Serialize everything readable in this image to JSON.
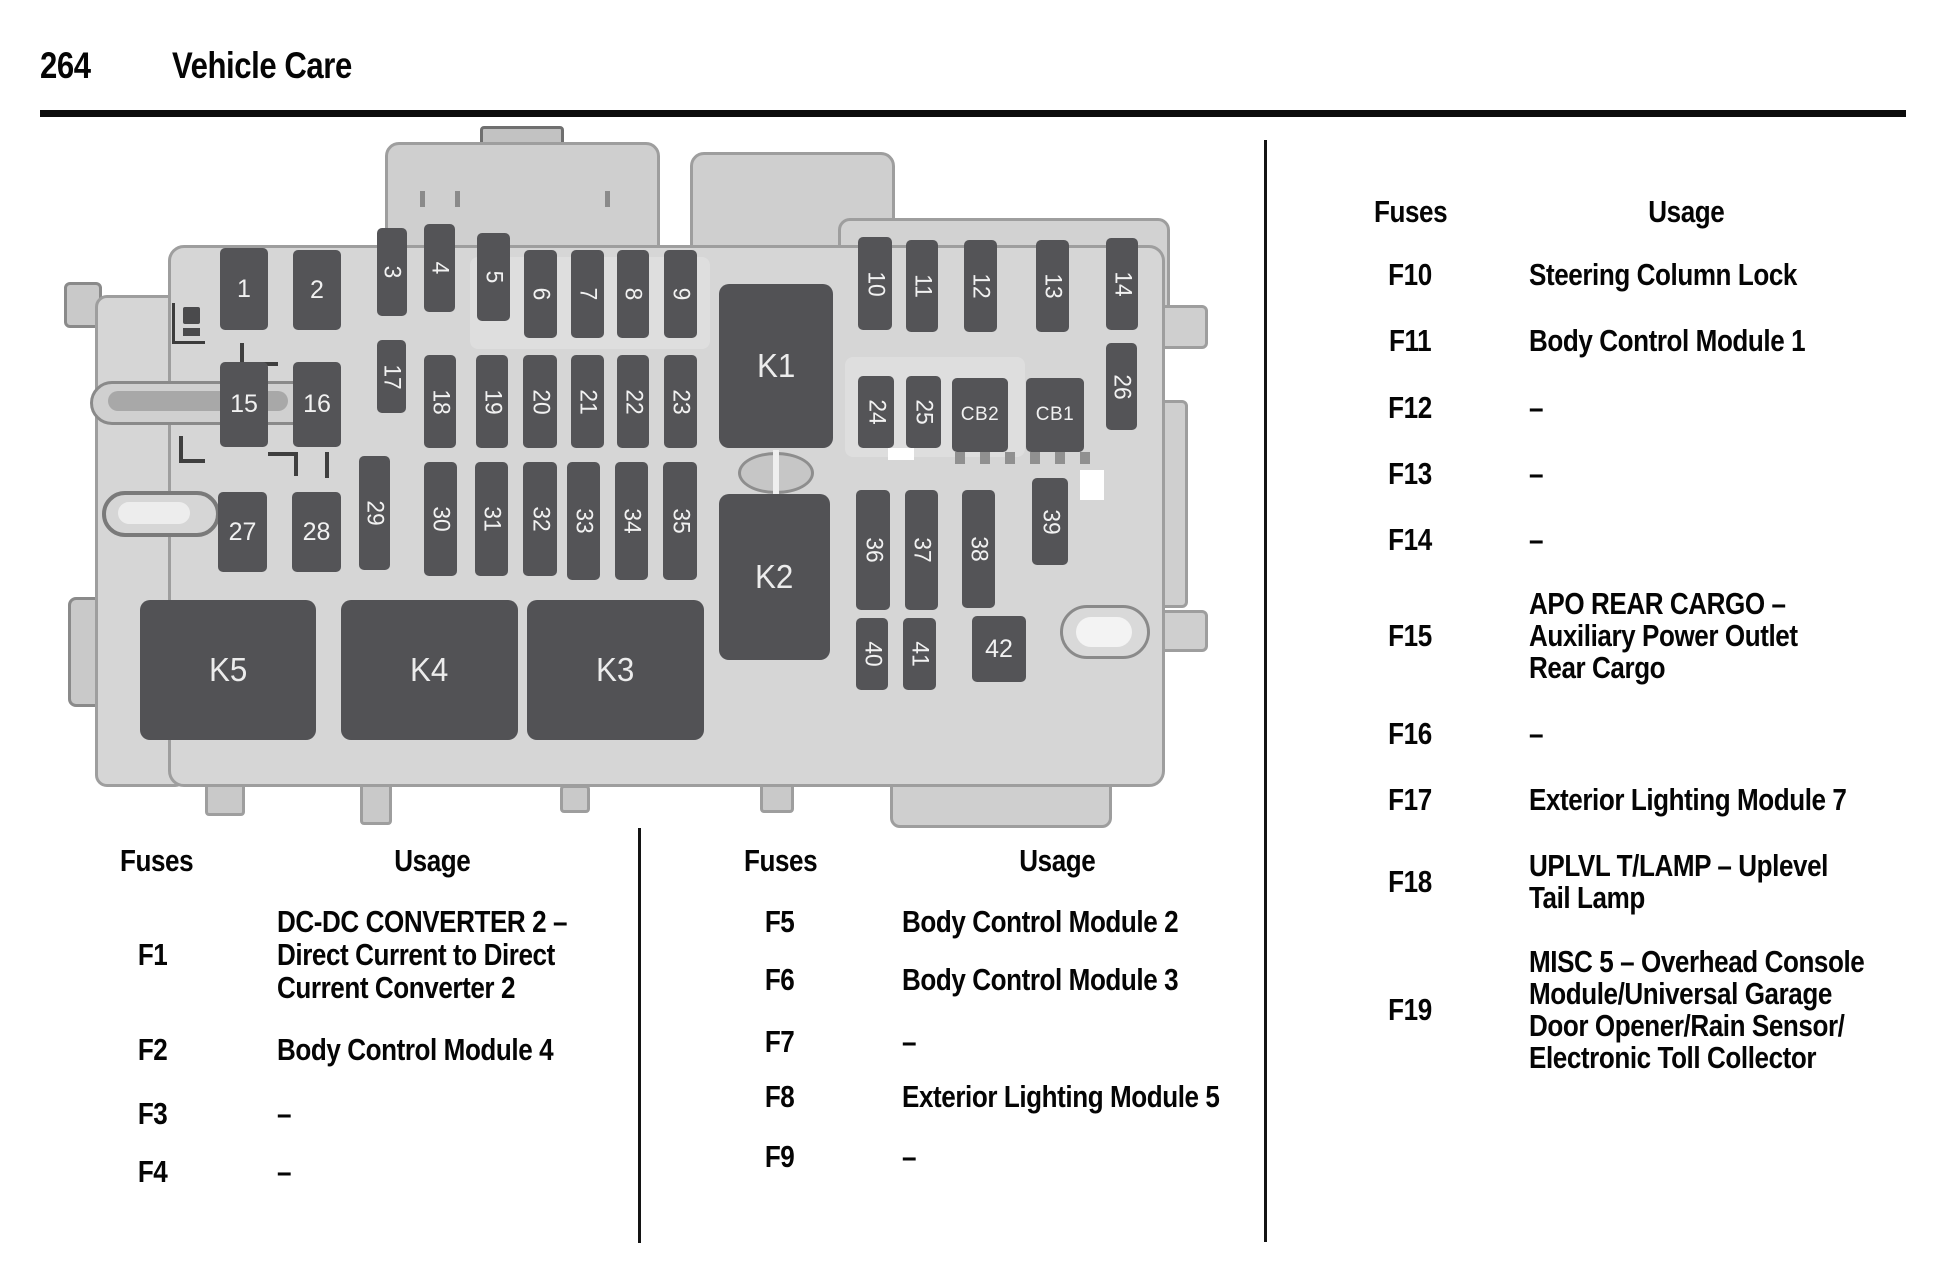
{
  "page": {
    "number": "264",
    "section_title": "Vehicle Care"
  },
  "diagram": {
    "description": "rear-compartment-fuse-block-illustration",
    "fuses": [
      "1",
      "2",
      "3",
      "4",
      "5",
      "6",
      "7",
      "8",
      "9",
      "10",
      "11",
      "12",
      "13",
      "14",
      "15",
      "16",
      "17",
      "18",
      "19",
      "20",
      "21",
      "22",
      "23",
      "24",
      "25",
      "26",
      "27",
      "28",
      "29",
      "30",
      "31",
      "32",
      "33",
      "34",
      "35",
      "36",
      "37",
      "38",
      "39",
      "40",
      "41",
      "42",
      "CB2",
      "CB1",
      "K1",
      "K2",
      "K3",
      "K4",
      "K5"
    ]
  },
  "tables": {
    "left": {
      "fuses_header": "Fuses",
      "usage_header": "Usage",
      "rows": [
        {
          "fuse": "F1",
          "lines": [
            "DC-DC CONVERTER 2 –",
            "Direct Current to Direct",
            "Current Converter 2"
          ]
        },
        {
          "fuse": "F2",
          "lines": [
            "Body Control Module 4"
          ]
        },
        {
          "fuse": "F3",
          "lines": [
            "–"
          ]
        },
        {
          "fuse": "F4",
          "lines": [
            "–"
          ]
        }
      ]
    },
    "middle": {
      "fuses_header": "Fuses",
      "usage_header": "Usage",
      "rows": [
        {
          "fuse": "F5",
          "lines": [
            "Body Control Module 2"
          ]
        },
        {
          "fuse": "F6",
          "lines": [
            "Body Control Module 3"
          ]
        },
        {
          "fuse": "F7",
          "lines": [
            "–"
          ]
        },
        {
          "fuse": "F8",
          "lines": [
            "Exterior Lighting Module 5"
          ]
        },
        {
          "fuse": "F9",
          "lines": [
            "–"
          ]
        }
      ]
    },
    "right": {
      "fuses_header": "Fuses",
      "usage_header": "Usage",
      "rows": [
        {
          "fuse": "F10",
          "lines": [
            "Steering Column Lock"
          ]
        },
        {
          "fuse": "F11",
          "lines": [
            "Body Control Module 1"
          ]
        },
        {
          "fuse": "F12",
          "lines": [
            "–"
          ]
        },
        {
          "fuse": "F13",
          "lines": [
            "–"
          ]
        },
        {
          "fuse": "F14",
          "lines": [
            "–"
          ]
        },
        {
          "fuse": "F15",
          "lines": [
            "APO REAR CARGO –",
            "Auxiliary Power Outlet",
            "Rear Cargo"
          ]
        },
        {
          "fuse": "F16",
          "lines": [
            "–"
          ]
        },
        {
          "fuse": "F17",
          "lines": [
            "Exterior Lighting Module 7"
          ]
        },
        {
          "fuse": "F18",
          "lines": [
            "UPLVL T/LAMP – Uplevel",
            "Tail Lamp"
          ]
        },
        {
          "fuse": "F19",
          "lines": [
            "MISC 5 – Overhead Console",
            "Module/Universal Garage",
            "Door Opener/Rain Sensor/",
            "Electronic Toll Collector"
          ]
        }
      ]
    }
  }
}
